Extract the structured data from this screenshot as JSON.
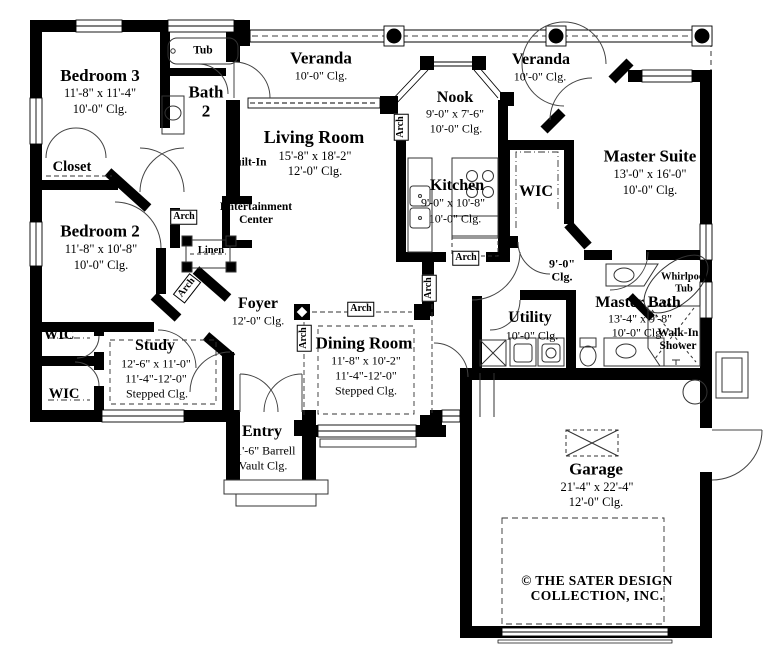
{
  "rooms": {
    "bedroom3": {
      "name": "Bedroom 3",
      "dims": "11'-8\" x 11'-4\"",
      "ceiling": "10'-0\" Clg."
    },
    "bath2": {
      "name": "Bath",
      "number": "2"
    },
    "tub": {
      "label": "Tub"
    },
    "closet": {
      "label": "Closet"
    },
    "veranda_left": {
      "name": "Veranda",
      "ceiling": "10'-0\" Clg."
    },
    "veranda_right": {
      "name": "Veranda",
      "ceiling": "10'-0\" Clg."
    },
    "living": {
      "name": "Living Room",
      "dims": "15'-8\" x 18'-2\"",
      "ceiling": "12'-0\" Clg."
    },
    "built_in": {
      "label": "Built-In"
    },
    "ent_center": {
      "line1": "Entertainment",
      "line2": "Center"
    },
    "nook": {
      "name": "Nook",
      "dims": "9'-0\" x 7'-6\"",
      "ceiling": "10'-0\" Clg."
    },
    "kitchen": {
      "name": "Kitchen",
      "dims": "9'-0\" x 10'-8\"",
      "ceiling": "10'-0\" Clg."
    },
    "wic_master": {
      "label": "WIC"
    },
    "master_suite": {
      "name": "Master Suite",
      "dims": "13'-0\" x 16'-0\"",
      "ceiling": "10'-0\" Clg."
    },
    "bedroom2": {
      "name": "Bedroom 2",
      "dims": "11'-8\" x 10'-8\"",
      "ceiling": "10'-0\" Clg."
    },
    "linen": {
      "label": "Linen"
    },
    "foyer": {
      "name": "Foyer",
      "ceiling": "12'-0\" Clg."
    },
    "hall": {
      "line1": "9'-0\"",
      "line2": "Clg."
    },
    "wic_upper": {
      "label": "WIC"
    },
    "wic_lower": {
      "label": "WIC"
    },
    "study": {
      "name": "Study",
      "dims": "12'-6\" x 11'-0\"",
      "range": "11'-4\"-12'-0\"",
      "ceiling": "Stepped Clg."
    },
    "dining": {
      "name": "Dining Room",
      "dims": "11'-8\" x 10'-2\"",
      "range": "11'-4\"-12'-0\"",
      "ceiling": "Stepped Clg."
    },
    "entry": {
      "name": "Entry",
      "line1": "11'-6\" Barrell",
      "line2": "Vault Clg."
    },
    "utility": {
      "name": "Utility",
      "ceiling": "10'-0\" Clg."
    },
    "master_bath": {
      "name": "Master Bath",
      "dims": "13'-4\" x 9'-8\"",
      "ceiling": "10'-0\" Clg."
    },
    "whirlpool": {
      "line1": "Whirlpool",
      "line2": "Tub"
    },
    "walkin": {
      "line1": "Walk-In",
      "line2": "Shower"
    },
    "garage": {
      "name": "Garage",
      "dims": "21'-4\" x 22'-4\"",
      "ceiling": "12'-0\" Clg."
    }
  },
  "annotations": {
    "arch": "Arch"
  },
  "footer": {
    "line1": "© THE SATER DESIGN",
    "line2": "COLLECTION, INC."
  },
  "colors": {
    "wall": "#000000",
    "paper": "#ffffff"
  }
}
